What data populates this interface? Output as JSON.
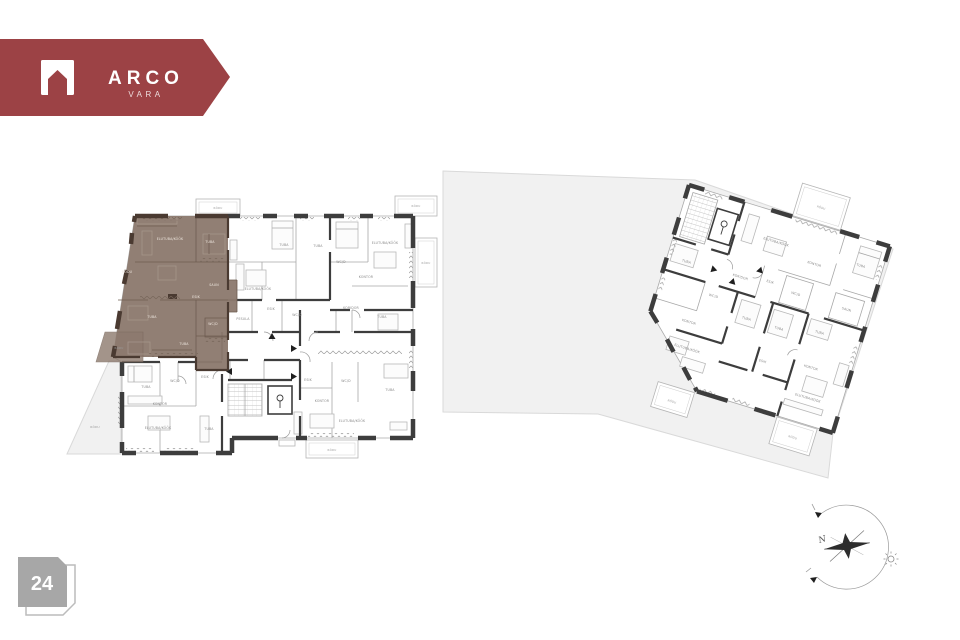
{
  "brand": {
    "name": "ARCO",
    "tagline": "VARA"
  },
  "floor_badge": {
    "number": "24"
  },
  "compass": {
    "north_label": "N"
  },
  "colors": {
    "brand_red": "#9c4245",
    "highlight_brown": "#8d7a6e",
    "highlight_wall": "#4a3a31",
    "wall_dark": "#3d3d3d",
    "site_gray": "#f1f1f1",
    "badge_gray": "#a7a7a7"
  },
  "plan": {
    "highlighted_apartment_labels": [
      {
        "t": "ELUTUBA/KÖÖK",
        "x": 170,
        "y": 240
      },
      {
        "t": "TUBA",
        "x": 210,
        "y": 243
      },
      {
        "t": "RÕDU",
        "x": 127,
        "y": 273
      },
      {
        "t": "SAUN",
        "x": 214,
        "y": 286
      },
      {
        "t": "ESIK",
        "x": 196,
        "y": 298
      },
      {
        "t": "TUBA",
        "x": 152,
        "y": 318
      },
      {
        "t": "WC/D",
        "x": 213,
        "y": 325
      },
      {
        "t": "TUBA",
        "x": 184,
        "y": 345
      },
      {
        "t": "RÕDU",
        "x": 119,
        "y": 349,
        "k": "balc"
      }
    ],
    "left_building_labels": [
      {
        "t": "RÕDU",
        "x": 218,
        "y": 209,
        "k": "balc"
      },
      {
        "t": "RÕDU",
        "x": 416,
        "y": 207,
        "k": "balc"
      },
      {
        "t": "RÕDU",
        "x": 426,
        "y": 264,
        "k": "balc"
      },
      {
        "t": "RÕDU",
        "x": 332,
        "y": 451,
        "k": "balc"
      },
      {
        "t": "TUBA",
        "x": 284,
        "y": 246
      },
      {
        "t": "TUBA",
        "x": 318,
        "y": 247
      },
      {
        "t": "ELUTUBA/KÖÖK",
        "x": 258,
        "y": 290
      },
      {
        "t": "PESULA",
        "x": 243,
        "y": 320
      },
      {
        "t": "ESIK",
        "x": 271,
        "y": 310
      },
      {
        "t": "WC/D",
        "x": 297,
        "y": 316
      },
      {
        "t": "ELUTUBA/KÖÖK",
        "x": 385,
        "y": 244
      },
      {
        "t": "KONTOR",
        "x": 366,
        "y": 278
      },
      {
        "t": "WC/D",
        "x": 341,
        "y": 263
      },
      {
        "t": "KORIDOR",
        "x": 351,
        "y": 309
      },
      {
        "t": "TUBA",
        "x": 382,
        "y": 318
      },
      {
        "t": "ESIK",
        "x": 308,
        "y": 381
      },
      {
        "t": "WC/D",
        "x": 346,
        "y": 382
      },
      {
        "t": "TUBA",
        "x": 390,
        "y": 391
      },
      {
        "t": "KONTOR",
        "x": 322,
        "y": 402
      },
      {
        "t": "ELUTUBA/KÖÖK",
        "x": 352,
        "y": 422
      },
      {
        "t": "TUBA",
        "x": 146,
        "y": 388
      },
      {
        "t": "WC/D",
        "x": 175,
        "y": 382
      },
      {
        "t": "ESIK",
        "x": 205,
        "y": 378
      },
      {
        "t": "KONTOR",
        "x": 160,
        "y": 405
      },
      {
        "t": "ELUTUBA/KÖÖK",
        "x": 158,
        "y": 429
      },
      {
        "t": "TUBA",
        "x": 209,
        "y": 430
      }
    ],
    "right_building_labels": [
      {
        "t": "RÕDU",
        "x": 133,
        "y": -16,
        "k": "balc"
      },
      {
        "t": "RÕDU",
        "x": 47,
        "y": 213,
        "k": "balc"
      },
      {
        "t": "RÕDU",
        "x": 173,
        "y": 212,
        "k": "balc"
      },
      {
        "t": "ELUTUBA/KÖÖK",
        "x": 100,
        "y": 30
      },
      {
        "t": "KONTOR",
        "x": 143,
        "y": 40
      },
      {
        "t": "TUBA",
        "x": 188,
        "y": 28
      },
      {
        "t": "TUBA",
        "x": 20,
        "y": 75
      },
      {
        "t": "KORIDOR",
        "x": 76,
        "y": 74
      },
      {
        "t": "ESIK",
        "x": 106,
        "y": 70
      },
      {
        "t": "WC/D",
        "x": 134,
        "y": 74
      },
      {
        "t": "SAUN",
        "x": 187,
        "y": 74
      },
      {
        "t": "WC/D",
        "x": 56,
        "y": 100
      },
      {
        "t": "TUBA",
        "x": 94,
        "y": 112
      },
      {
        "t": "TUBA",
        "x": 128,
        "y": 112
      },
      {
        "t": "TUBA",
        "x": 168,
        "y": 104
      },
      {
        "t": "KONTOR",
        "x": 40,
        "y": 132
      },
      {
        "t": "ELUTUBA/KÖÖK",
        "x": 46,
        "y": 158
      },
      {
        "t": "ESIK",
        "x": 122,
        "y": 148
      },
      {
        "t": "KONTOR",
        "x": 170,
        "y": 140
      },
      {
        "t": "ELUTUBA/KÖÖK",
        "x": 176,
        "y": 170
      }
    ],
    "site_labels": [
      {
        "t": "RÕDU",
        "x": 95,
        "y": 428
      }
    ]
  }
}
